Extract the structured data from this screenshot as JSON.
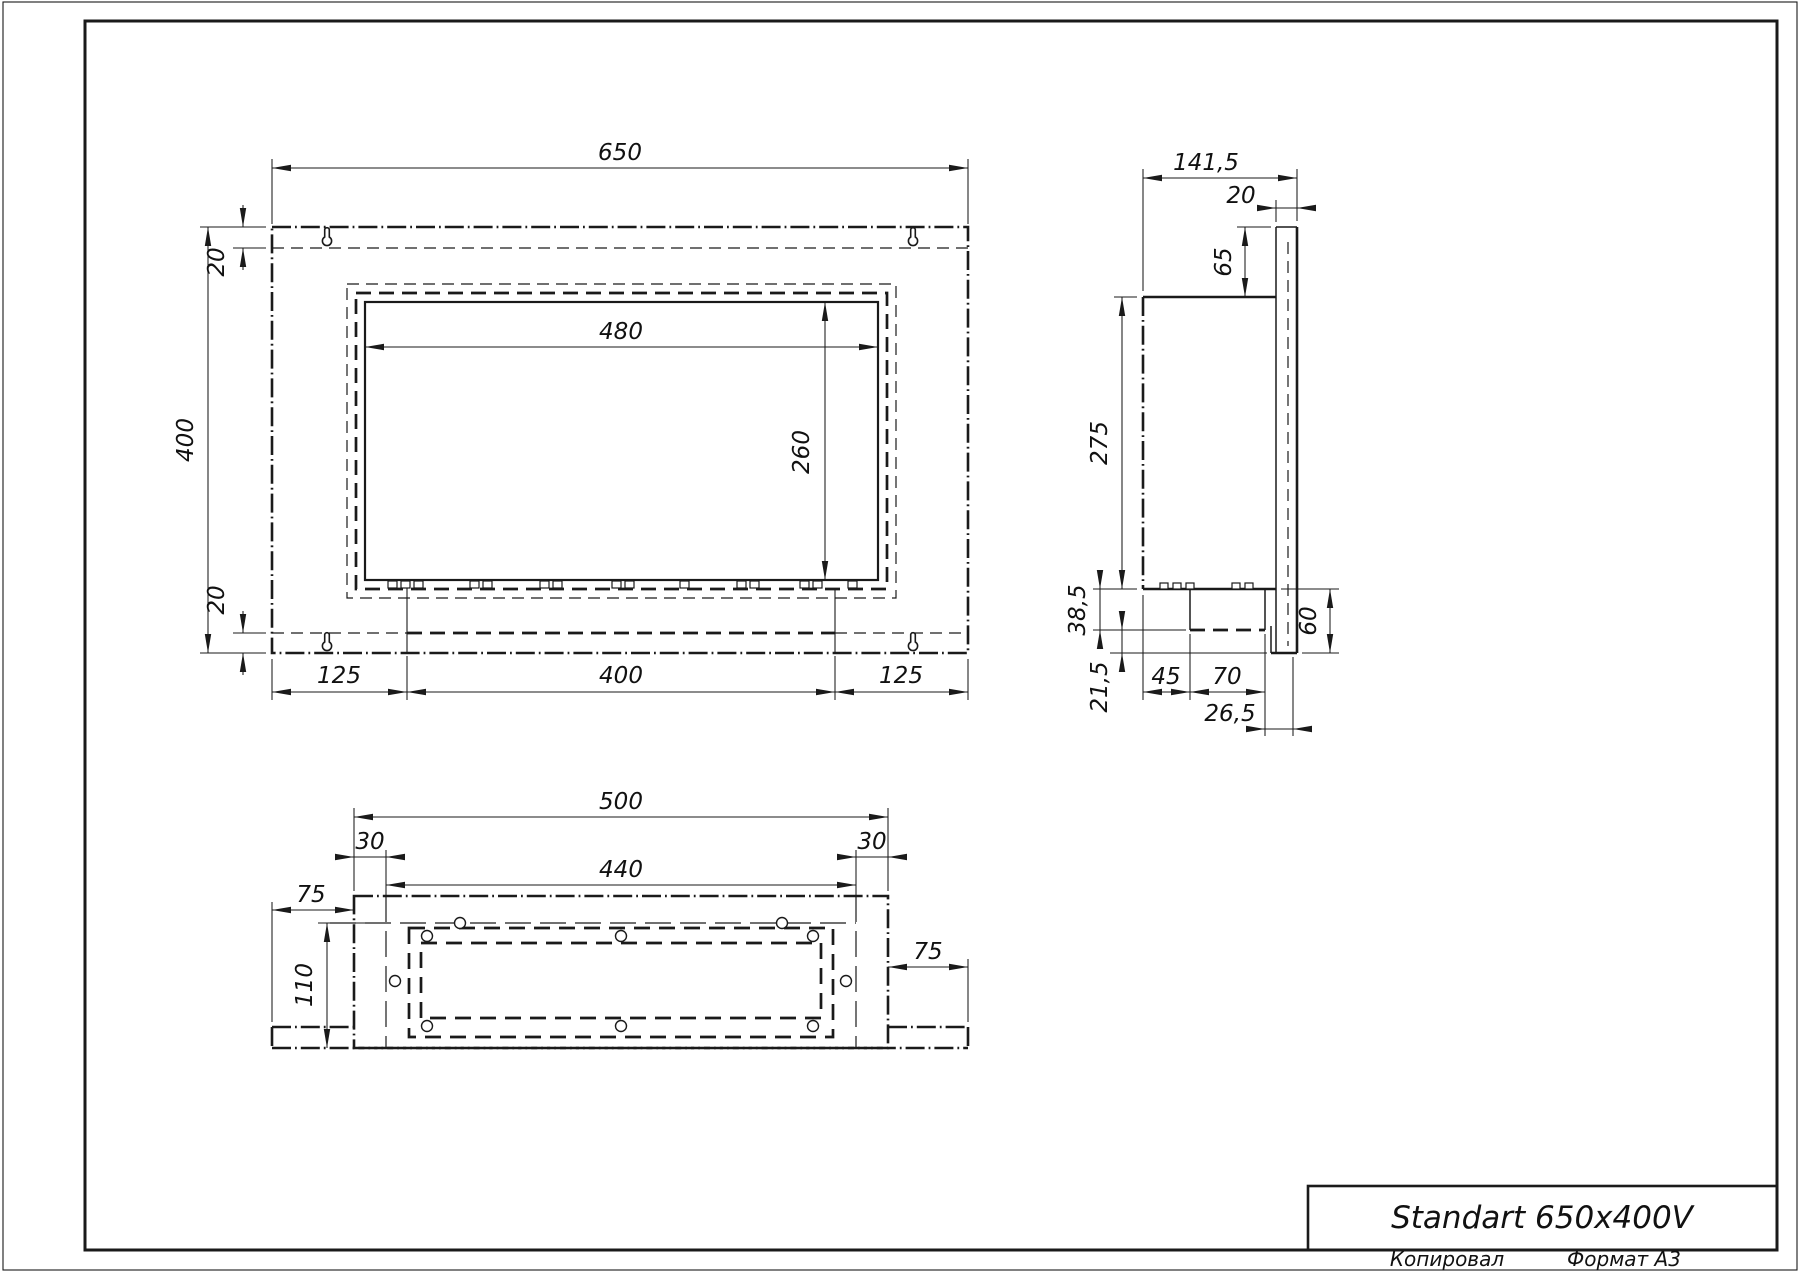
{
  "sheet": {
    "paper_color": "#ffffff",
    "ink_color": "#1a1a1a"
  },
  "title_block": {
    "title": "Standart 650x400V",
    "copied_label": "Копировал",
    "format_label": "Формат А3"
  },
  "dims": {
    "front": {
      "width": "650",
      "height": "400",
      "top_inset": "20",
      "bottom_inset": "20",
      "opening_width": "480",
      "opening_height": "260",
      "foot_left": "125",
      "foot_center": "400",
      "foot_right": "125"
    },
    "side": {
      "depth": "141,5",
      "plate_thickness": "20",
      "tab_height": "65",
      "body_height": "275",
      "lower_height": "38,5",
      "foot_height": "21,5",
      "inset_left": "45",
      "burner_width": "70",
      "right_offset": "26,5",
      "bracket_height": "60"
    },
    "bottom": {
      "width": "500",
      "margin_left": "30",
      "margin_right": "30",
      "inner_width": "440",
      "wing_left": "75",
      "wing_right": "75",
      "depth": "110"
    }
  }
}
